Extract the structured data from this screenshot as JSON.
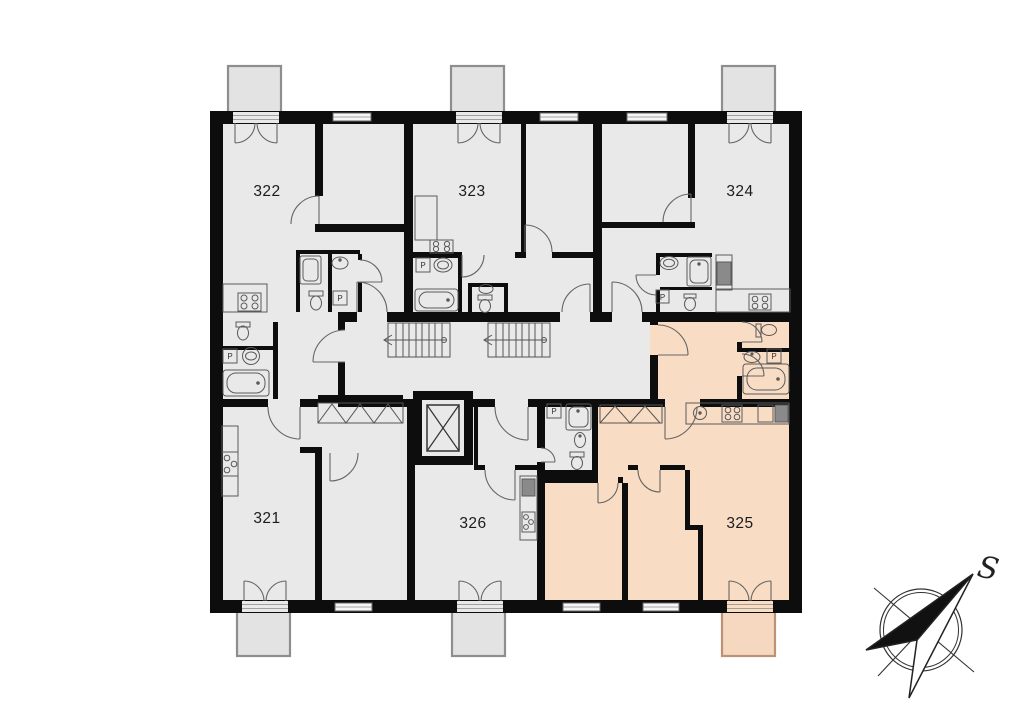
{
  "plan": {
    "apartments": [
      {
        "number": "321",
        "highlighted": false
      },
      {
        "number": "322",
        "highlighted": false
      },
      {
        "number": "323",
        "highlighted": false
      },
      {
        "number": "324",
        "highlighted": false
      },
      {
        "number": "325",
        "highlighted": true
      },
      {
        "number": "326",
        "highlighted": false
      }
    ],
    "fixture_labels": {
      "washer": "P"
    },
    "compass": {
      "label": "S"
    },
    "colors": {
      "wall": "#0d0d0d",
      "room": "#e9e9e9",
      "highlight": "#f8dcc4",
      "balcony": "#e3e3e3",
      "balcony_highlight": "#f6d8c0",
      "background": "#ffffff"
    }
  }
}
